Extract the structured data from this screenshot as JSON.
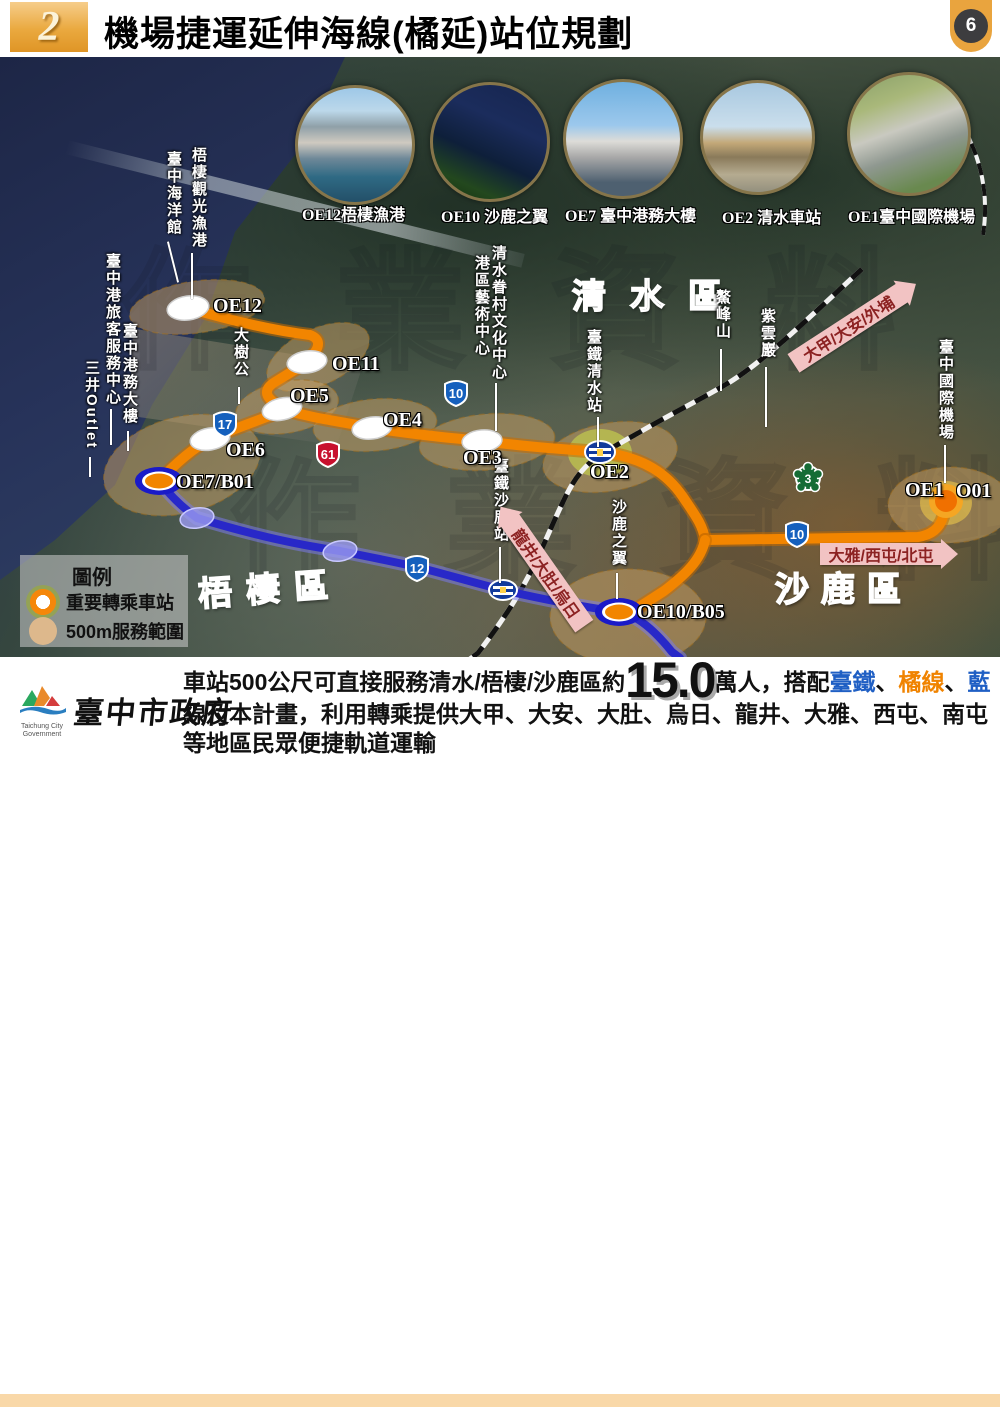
{
  "page": {
    "slide_number": "2",
    "title": "機場捷運延伸海線(橘延)站位規劃",
    "page_number": "6"
  },
  "photos": [
    {
      "caption": "OE12梧棲漁港"
    },
    {
      "caption": "OE10 沙鹿之翼"
    },
    {
      "caption": "OE7 臺中港務大樓"
    },
    {
      "caption": "OE2 清水車站"
    },
    {
      "caption": "OE1臺中國際機場"
    }
  ],
  "map": {
    "watermark": "作業資料",
    "regions": {
      "qingshui": "清水區",
      "wuqi": "梧棲區",
      "shalu": "沙鹿區"
    },
    "stations": {
      "oe12": "OE12",
      "oe11": "OE11",
      "oe5": "OE5",
      "oe4": "OE4",
      "oe6": "OE6",
      "oe3": "OE3",
      "oe2": "OE2",
      "oe7": "OE7/B01",
      "oe10": "OE10/B05",
      "oe1": "OE1",
      "o01": "O01"
    },
    "pois": {
      "wuqi_fishing": "梧棲觀光漁港",
      "ocean_museum": "臺中海洋館",
      "port_passenger": "臺中港旅客服務中心",
      "port_building": "臺中港務大樓",
      "mitsui": "三井Outlet",
      "big_tree": "大樹公",
      "qingshui_village": "清水眷村文化中心",
      "art_center": "港區藝術中心",
      "tra_qingshui": "臺鐵清水站",
      "ziyun": "紫雲巖",
      "aofeng": "鰲峰山",
      "airport": "臺中國際機場",
      "tra_shalu": "臺鐵沙鹿站",
      "shalu_wing": "沙鹿之翼"
    },
    "signs": {
      "dajia": "大甲/大安/外埔",
      "daya": "大雅/西屯/北屯",
      "longjing": "龍井/大肚/烏日"
    },
    "shields": {
      "s17": "17",
      "s61": "61",
      "s10": "10",
      "s3": "3",
      "s10b": "10",
      "s12": "12"
    }
  },
  "legend": {
    "title": "圖例",
    "transfer": "重要轉乘車站",
    "range": "500m服務範圍"
  },
  "footer": {
    "seg1": "車站500公尺可直接服務清水/梧棲/沙鹿區約",
    "big": "15.0",
    "seg2": "萬人，搭配",
    "tra": "臺鐵",
    "d1": "、",
    "orange_line": "橘線",
    "d2": "、",
    "blue_line": "藍",
    "seg3": "線及本計畫，利用轉乘提供大甲、大安、大肚、烏日、龍井、大雅、西屯、南屯等地區民眾便捷軌道運輸"
  },
  "logo": {
    "zh": "臺中市政府",
    "en": "Taichung City Government"
  },
  "colors": {
    "orange_line": "#f28500",
    "blue_line": "#2828c8",
    "accent_blue": "#1f5fc4",
    "accent_orange": "#f08300"
  }
}
